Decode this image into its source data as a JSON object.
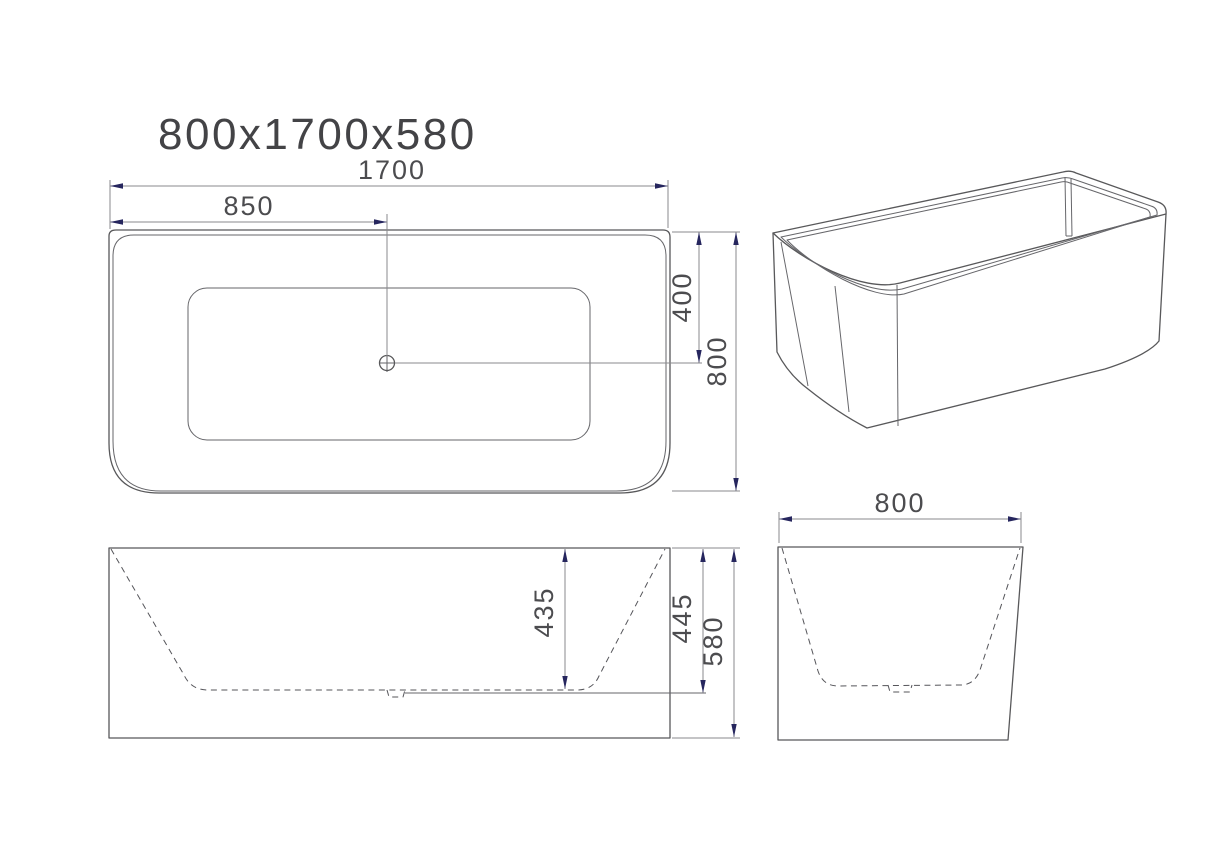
{
  "title": "800x1700x580",
  "views": {
    "top": {
      "label": "top-view",
      "dims": {
        "length": "1700",
        "drain_from_left": "850",
        "drain_from_back": "400",
        "width": "800"
      }
    },
    "front": {
      "label": "front-elevation",
      "dims": {
        "basin_depth": "435",
        "drain_depth": "445",
        "overall_height": "580"
      }
    },
    "side": {
      "label": "side-elevation",
      "dims": {
        "width": "800"
      }
    },
    "perspective": {
      "label": "3d-perspective-view"
    }
  },
  "colors": {
    "object_line": "#58585a",
    "dimension_line": "#8a8a8d",
    "arrow": "#26265e",
    "text": "#4c4c4f",
    "background": "#ffffff"
  }
}
